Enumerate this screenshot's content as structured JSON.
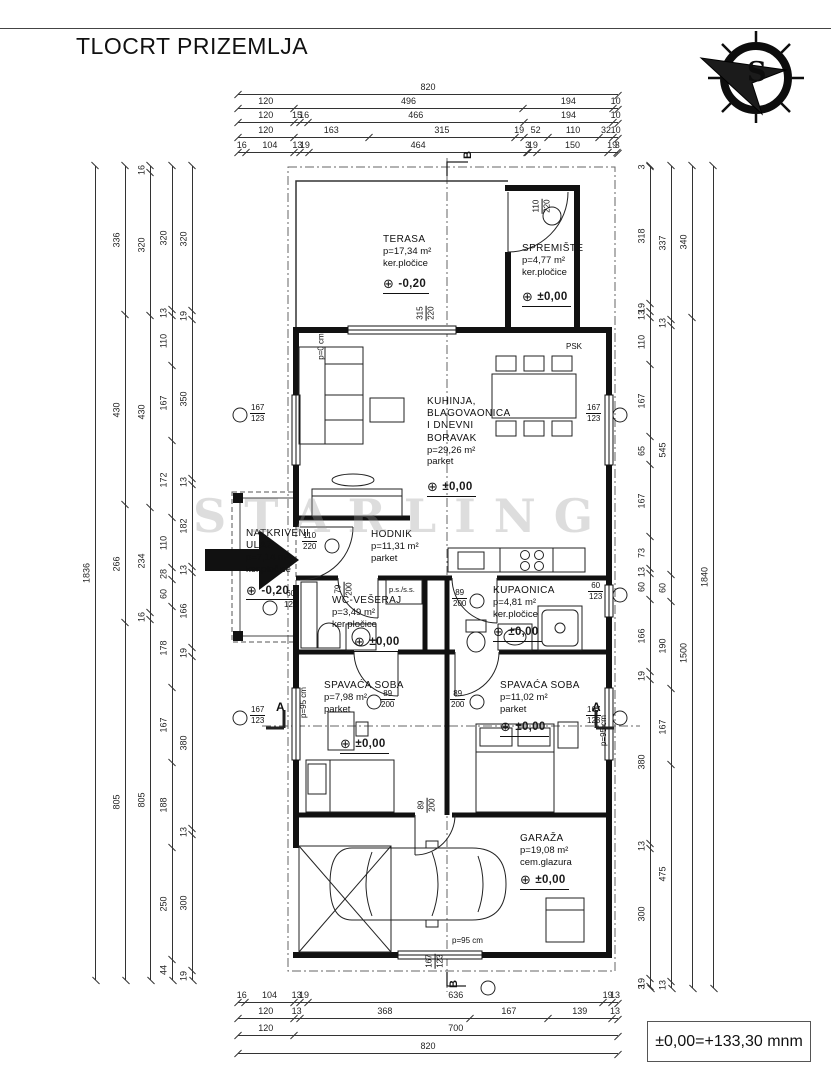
{
  "title": "TLOCRT PRIZEMLJA",
  "footer": {
    "datum_label": "±0,00=+133,30 mnm"
  },
  "watermark": "STARLING",
  "icons": {
    "level_marker": "⊕",
    "compass_letter": "S"
  },
  "section_marks": {
    "a_left": "A",
    "a_right": "A",
    "b_top": "B",
    "b_bottom": "B"
  },
  "rooms": {
    "terasa": {
      "name": "TERASA",
      "area": "p=17,34 m²",
      "floor": "ker.pločice",
      "level": "-0,20"
    },
    "spremiste": {
      "name": "SPREMIŠTE",
      "area": "p=4,77 m²",
      "floor": "ker.pločice",
      "level": "±0,00"
    },
    "kuhinja": {
      "name": "KUHINJA,\nBLAGOVAONICA\nI DNEVNI\nBORAVAK",
      "area": "p=29,26 m²",
      "floor": "parket",
      "level": "±0,00"
    },
    "hodnik": {
      "name": "HODNIK",
      "area": "p=11,31 m²",
      "floor": "parket"
    },
    "ulaz": {
      "name": "NATKRIVENI\nULAZ",
      "area": "p=7,14 m²",
      "floor": "ker.pločice",
      "level": "-0,20"
    },
    "wc": {
      "name": "WC-VEŠERAJ",
      "area": "p=3,49 m²",
      "floor": "ker.pločice",
      "level": "±0,00"
    },
    "kupaonica": {
      "name": "KUPAONICA",
      "area": "p=4,81 m²",
      "floor": "ker.pločice",
      "level": "±0,00"
    },
    "soba1": {
      "name": "SPAVAĆA SOBA",
      "area": "p=7,98 m²",
      "floor": "parket",
      "level": "±0,00"
    },
    "soba2": {
      "name": "SPAVAĆA SOBA",
      "area": "p=11,02 m²",
      "floor": "parket",
      "level": "±0,00"
    },
    "garaza": {
      "name": "GARAŽA",
      "area": "p=19,08 m²",
      "floor": "cem.glazura",
      "level": "±0,00"
    }
  },
  "openings": [
    {
      "w": "110",
      "h": "220"
    },
    {
      "w": "315",
      "h": "220"
    },
    {
      "w": "167",
      "h": "123"
    },
    {
      "w": "167",
      "h": "123"
    },
    {
      "w": "110",
      "h": "220"
    },
    {
      "w": "60",
      "h": "123"
    },
    {
      "w": "79",
      "h": "200"
    },
    {
      "w": "89",
      "h": "200"
    },
    {
      "w": "60",
      "h": "123"
    },
    {
      "w": "89",
      "h": "200"
    },
    {
      "w": "89",
      "h": "200"
    },
    {
      "w": "167",
      "h": "123"
    },
    {
      "w": "167",
      "h": "123"
    },
    {
      "w": "89",
      "h": "200"
    },
    {
      "w": "167",
      "h": "123"
    }
  ],
  "annotations": {
    "psk": "PSK",
    "ps_ss": "p.s./s.s.",
    "parapet_left": "p=95 cm",
    "parapet_right": "p=95 cm",
    "parapet_garage": "p=95 cm",
    "parapet_zero": "p=0 cm"
  },
  "dims": {
    "top": [
      [
        "820"
      ],
      [
        "120",
        "496",
        "194",
        "10"
      ],
      [
        "120",
        "15",
        "16",
        "466",
        "194",
        "10"
      ],
      [
        "120",
        "163",
        "315",
        "19",
        "52",
        "110",
        "32",
        "10"
      ],
      [
        "16",
        "104",
        "13",
        "19",
        "464",
        "3",
        "19",
        "150",
        "19",
        "3"
      ]
    ],
    "bottom": [
      [
        "16",
        "104",
        "13",
        "19",
        "636",
        "19",
        "13"
      ],
      [
        "120",
        "13",
        "368",
        "167",
        "139",
        "13"
      ],
      [
        "120",
        "700"
      ],
      [
        "820"
      ]
    ],
    "left": [
      [
        "1836"
      ],
      [
        "336",
        "430",
        "266",
        "805"
      ],
      [
        "16",
        "320",
        "430",
        "234",
        "16",
        "805"
      ],
      [
        "320",
        "13",
        "110",
        "167",
        "172",
        "110",
        "28",
        "60",
        "178",
        "167",
        "188",
        "250",
        "44"
      ],
      [
        "320",
        "19",
        "350",
        "13",
        "182",
        "13",
        "166",
        "19",
        "380",
        "13",
        "300",
        "19"
      ]
    ],
    "right": [
      [
        "3",
        "318",
        "19",
        "13",
        "110",
        "167",
        "65",
        "167",
        "73",
        "13",
        "60",
        "166",
        "19",
        "380",
        "13",
        "300",
        "19",
        "3"
      ],
      [
        "337",
        "13",
        "545",
        "60",
        "190",
        "167",
        "475",
        "13"
      ],
      [
        "340",
        "1500"
      ],
      [
        "1840"
      ]
    ]
  }
}
